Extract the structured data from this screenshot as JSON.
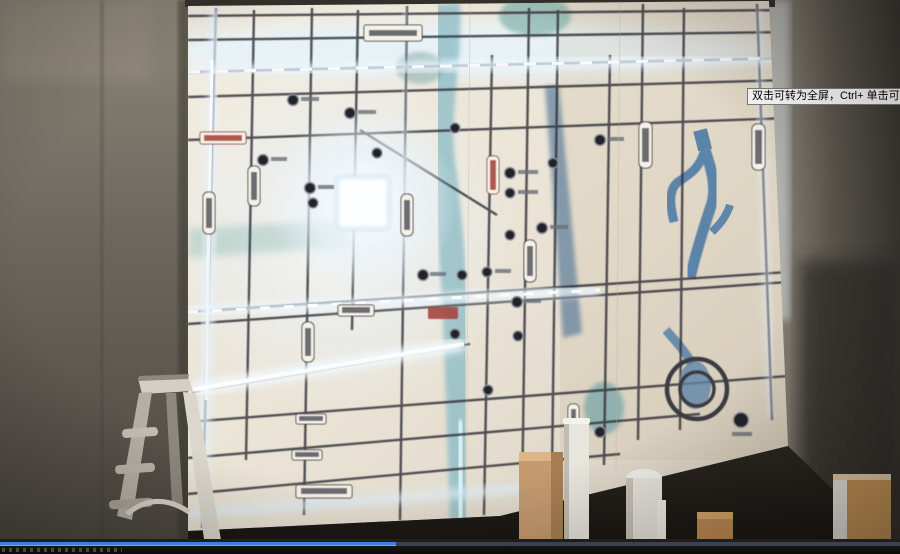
{
  "video_player": {
    "tooltip_text": "双击可转为全屏，Ctrl+ 单击可转为全屏",
    "progress": {
      "filled_fraction_percent": 44,
      "filled_color": "#3b7de0",
      "track_color": "#3a4150"
    }
  },
  "scene": {
    "map_panel": {
      "label_plates_legible": false,
      "highlight": "glowing-white-project-block",
      "features": [
        "road-grid",
        "lit-roads",
        "river",
        "roundabout-rings",
        "project-badges"
      ]
    },
    "colors": {
      "map_glow": "#e9f6ff",
      "river_teal": "#8fbdc6",
      "deep_river_blue": "#557ea3",
      "wall_grey": "#6b665e",
      "ladder_aluminum": "#cfc9be",
      "crate_tan": "#c59a6f"
    }
  }
}
